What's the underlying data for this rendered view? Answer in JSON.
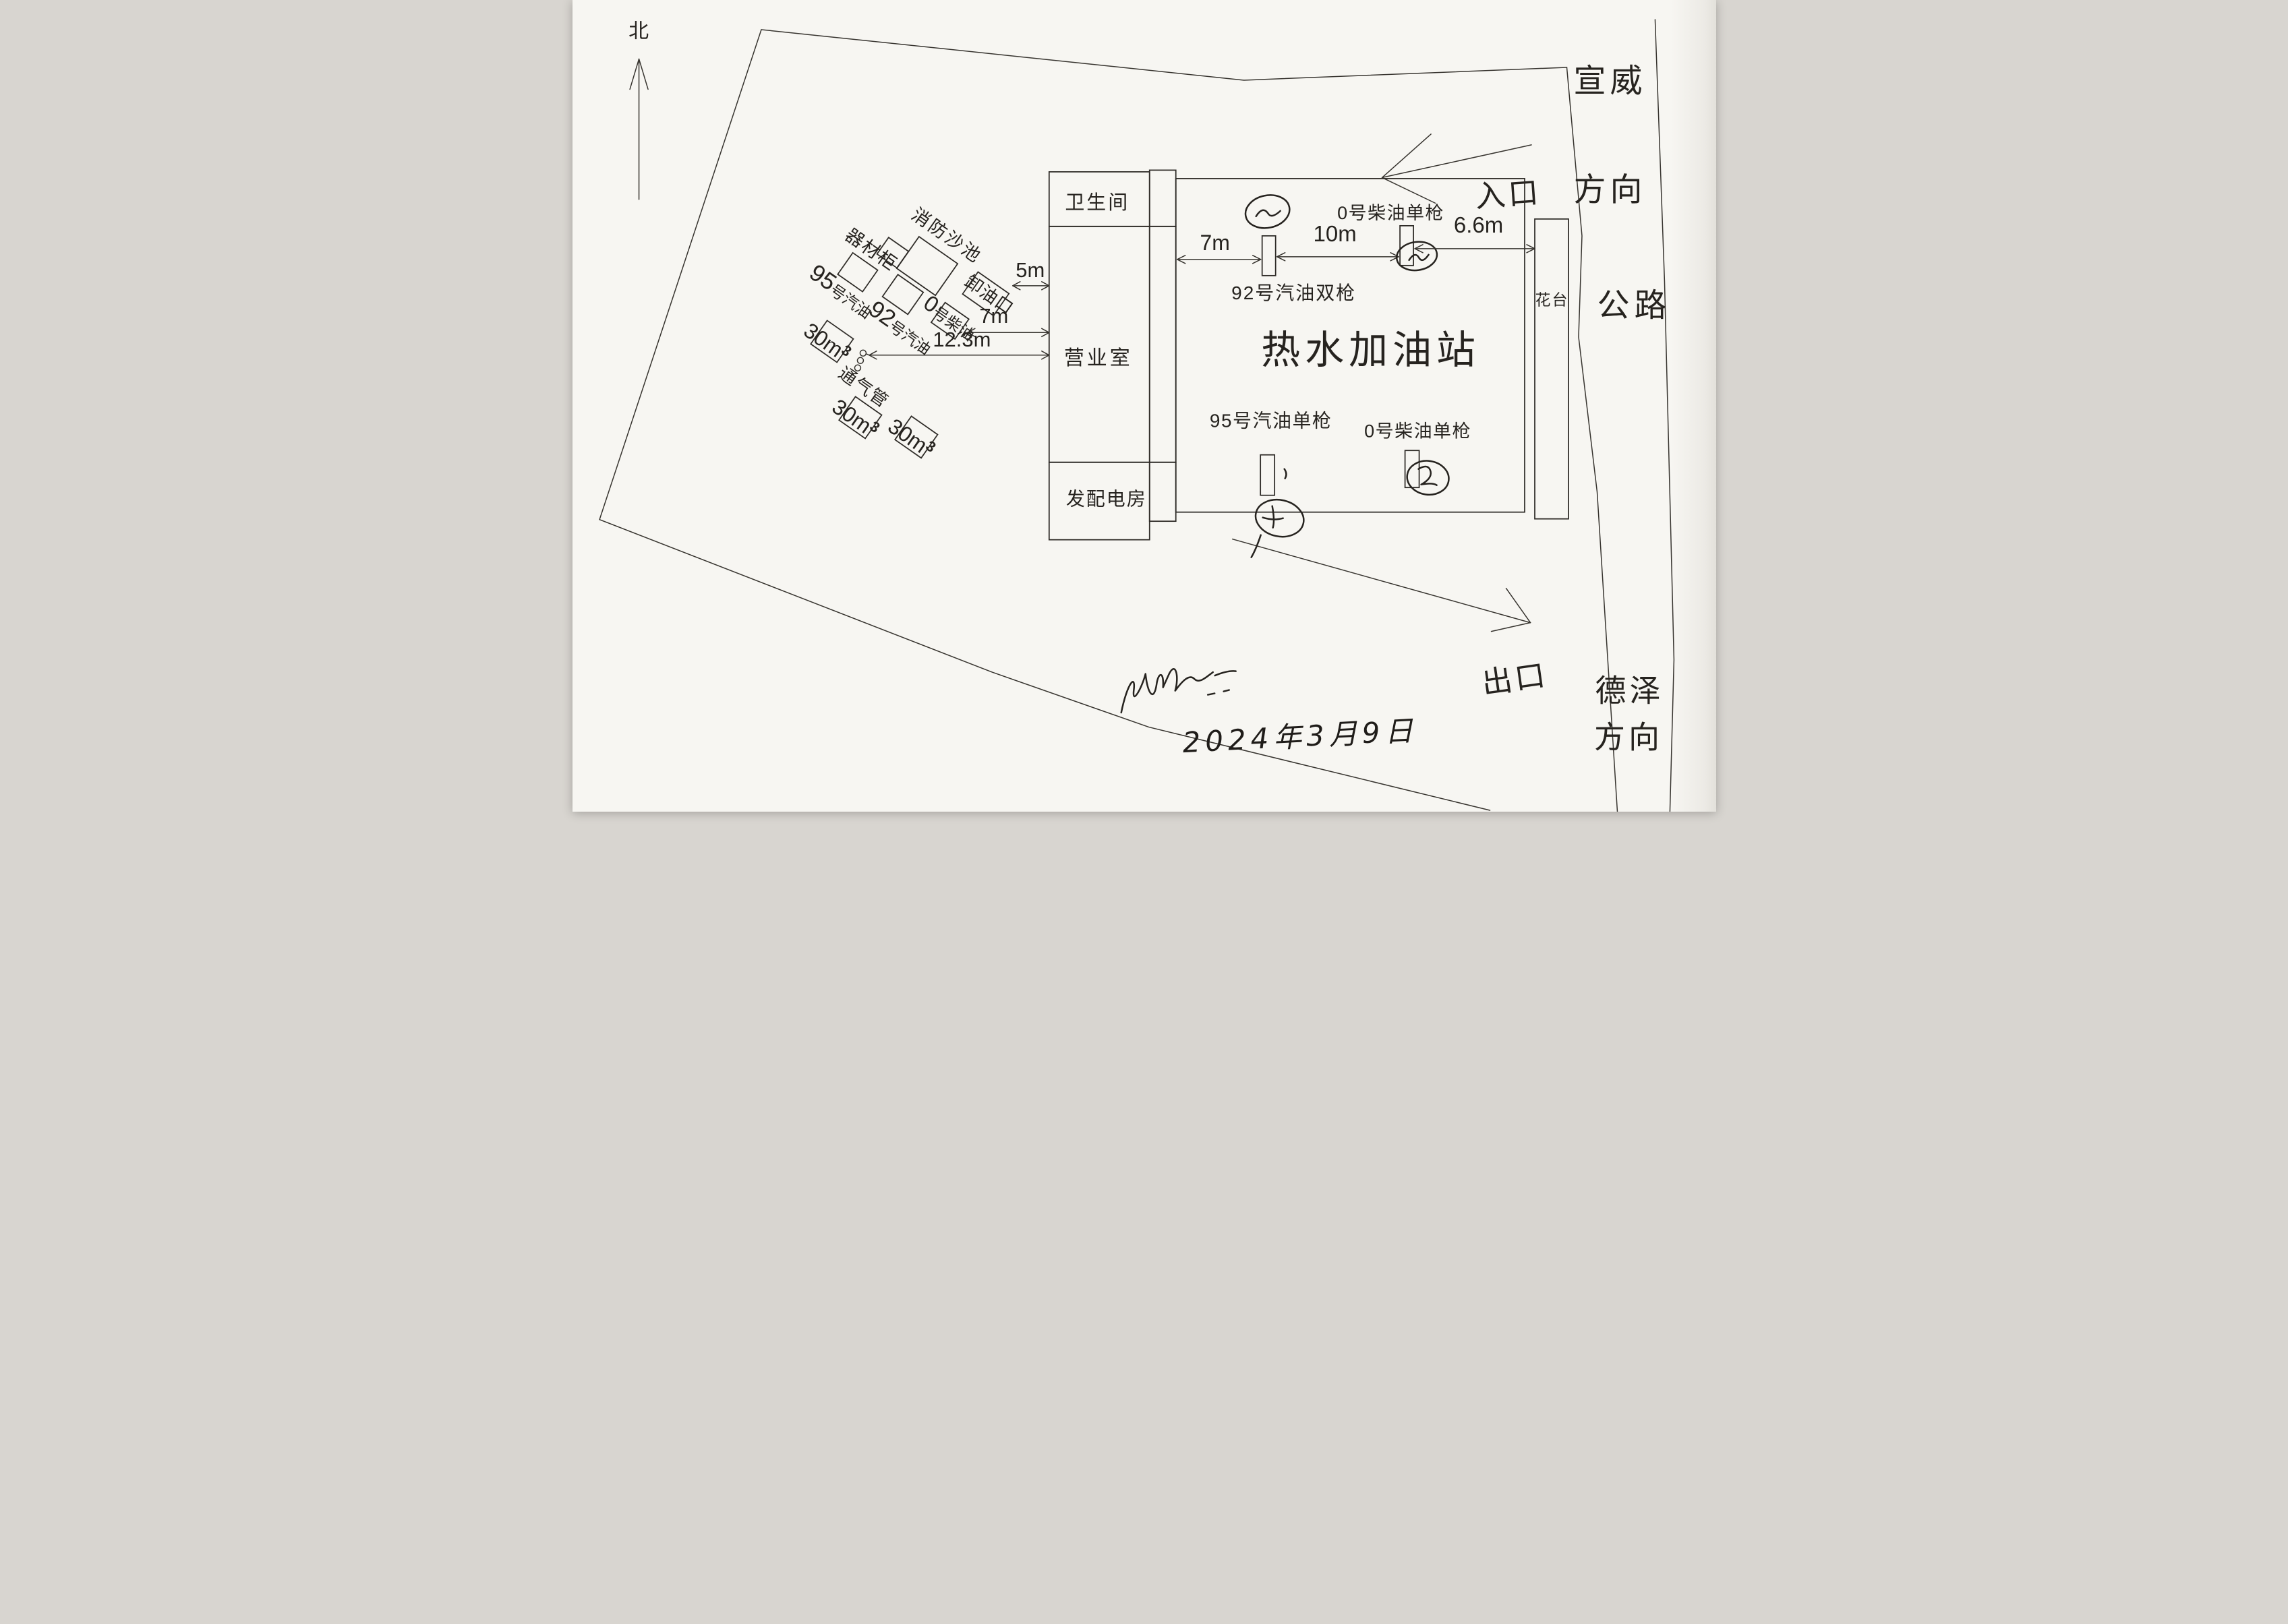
{
  "document": {
    "kind": "hand-drawn gas station site plan (scanned)",
    "station_name": "热水加油站",
    "date": "2024年3月9日"
  },
  "compass": {
    "north": "北"
  },
  "directions": {
    "top_right_line1": "宣威",
    "top_right_line2": "方向",
    "bottom_right_line1": "德泽",
    "bottom_right_line2": "方向",
    "road": "公路",
    "entrance": "入口",
    "exit": "出口"
  },
  "building": {
    "toilet": "卫生间",
    "office": "营业室",
    "power_room": "发配电房"
  },
  "canopy": {
    "station_name": "热水加油站",
    "islands": {
      "gas92_double": "92号汽油双枪",
      "diesel0_single_top": "0号柴油单枪",
      "gas95_single": "95号汽油单枪",
      "diesel0_single_bottom": "0号柴油单枪"
    }
  },
  "dimensions": {
    "unload_to_building": "5m",
    "diesel_tank_to_building": "7m",
    "vent_to_building": "12.3m",
    "canopy_to_island1": "7m",
    "island1_to_island2": "10m",
    "island2_to_flowerbed": "6.6m"
  },
  "tank_farm": {
    "equipment_cabinet": "器材柜",
    "fire_sand_pool": "消防沙池",
    "unloading_port": "卸油口",
    "vent_pipe": "通气管",
    "tank95": {
      "num": "95",
      "suffix": "号汽油"
    },
    "tank92": {
      "num": "92",
      "suffix": "号汽油"
    },
    "tank0": {
      "num": "0",
      "suffix": "号柴油"
    },
    "storage_volume": "30m",
    "storage_sup": "3"
  },
  "flower_bed": "花台",
  "footer": {
    "date": "2024年3月9日"
  }
}
